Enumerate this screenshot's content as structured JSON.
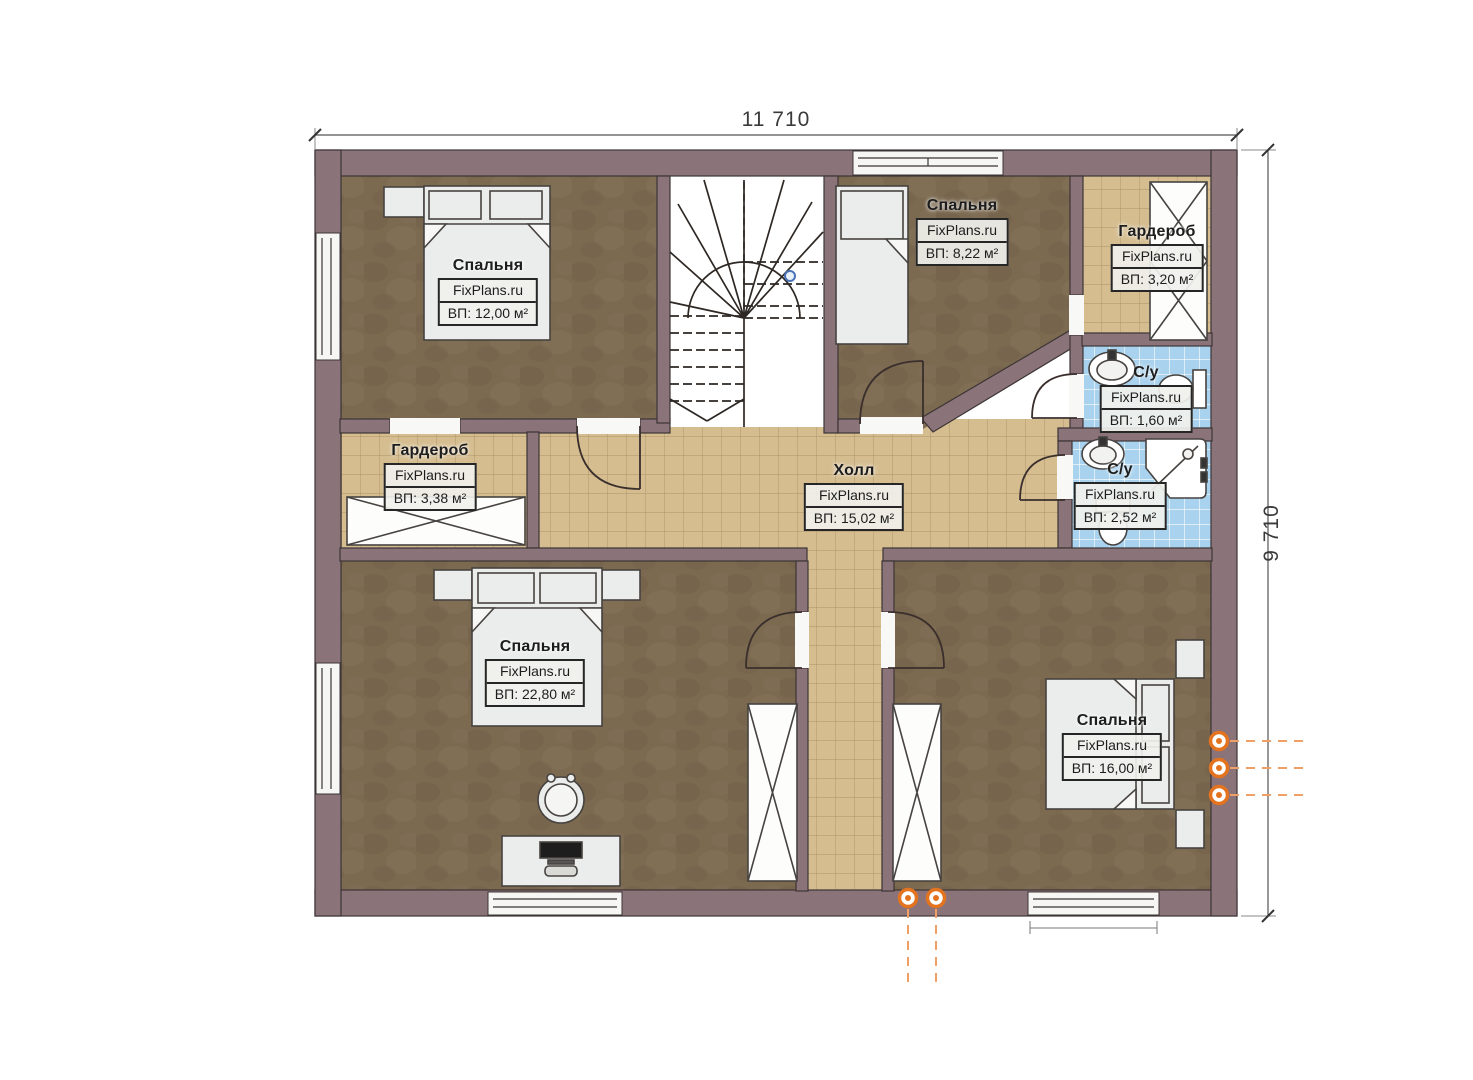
{
  "plan_title": "Floor plan (second floor)",
  "dimensions": {
    "top": "11 710",
    "right": "9 710"
  },
  "brand": "FixPlans.ru",
  "rooms": [
    {
      "key": "bedroom-top-left",
      "name": "Спальня",
      "brand": "FixPlans.ru",
      "area": "ВП: 12,00 м²"
    },
    {
      "key": "bedroom-top-middle",
      "name": "Спальня",
      "brand": "FixPlans.ru",
      "area": "ВП: 8,22 м²"
    },
    {
      "key": "wardrobe-top-right",
      "name": "Гардероб",
      "brand": "FixPlans.ru",
      "area": "ВП: 3,20 м²"
    },
    {
      "key": "bathroom-small",
      "name": "С/у",
      "brand": "FixPlans.ru",
      "area": "ВП: 1,60 м²"
    },
    {
      "key": "bathroom-large",
      "name": "С/у",
      "brand": "FixPlans.ru",
      "area": "ВП: 2,52 м²"
    },
    {
      "key": "wardrobe-left",
      "name": "Гардероб",
      "brand": "FixPlans.ru",
      "area": "ВП: 3,38 м²"
    },
    {
      "key": "hall",
      "name": "Холл",
      "brand": "FixPlans.ru",
      "area": "ВП: 15,02 м²"
    },
    {
      "key": "bedroom-bottom-left",
      "name": "Спальня",
      "brand": "FixPlans.ru",
      "area": "ВП: 22,80 м²"
    },
    {
      "key": "bedroom-bottom-right",
      "name": "Спальня",
      "brand": "FixPlans.ru",
      "area": "ВП: 16,00 м²"
    }
  ],
  "colors": {
    "wall": "#8b737a",
    "outline": "#3c3536",
    "carpet": "#7b6950",
    "tile_beige": "#d5bd90",
    "tile_blue": "#a9d2ee",
    "furniture": "#ebedec",
    "marker_orange": "#e4731f"
  }
}
